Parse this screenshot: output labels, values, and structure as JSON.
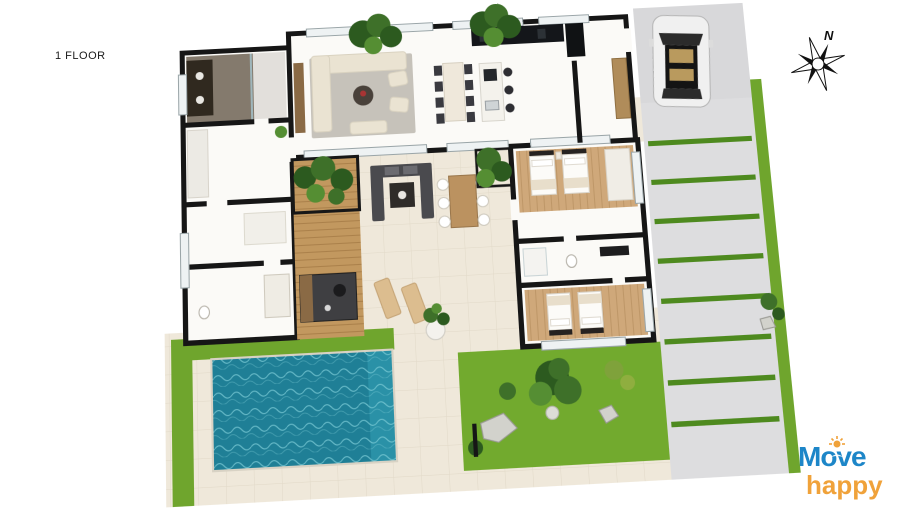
{
  "frame": {
    "width": 900,
    "height": 515,
    "background": "#ffffff"
  },
  "floor_label": "1 FLOOR",
  "compass": {
    "north_label": "N"
  },
  "logo": {
    "word_top": "Move",
    "word_bottom": "happy"
  },
  "colors": {
    "accent_blue": "#1d86c8",
    "accent_orange": "#f0a23a",
    "wall": "#161616",
    "floor": "#fbfaf7",
    "patio": "#efe8da",
    "tilejoint": "#e2dac9",
    "wood": "#cfa87a",
    "deck": "#c2985f",
    "pool": "#1f7f96",
    "pool_ripple": "#79c9d4",
    "grass": "#6fa52d",
    "grass_dark": "#4e8a1f",
    "lawn": "#72aa2e",
    "driveway": "#dddddf",
    "parking": "#d8d8da",
    "rug": "#c6c2ba",
    "sofa": "#eae3d2",
    "tree_dark": "#2c5a1f",
    "tree_mid": "#3e7029",
    "tree_light": "#558e33",
    "car_body": "#f0f0f0",
    "rock": "#d2d2cc"
  }
}
